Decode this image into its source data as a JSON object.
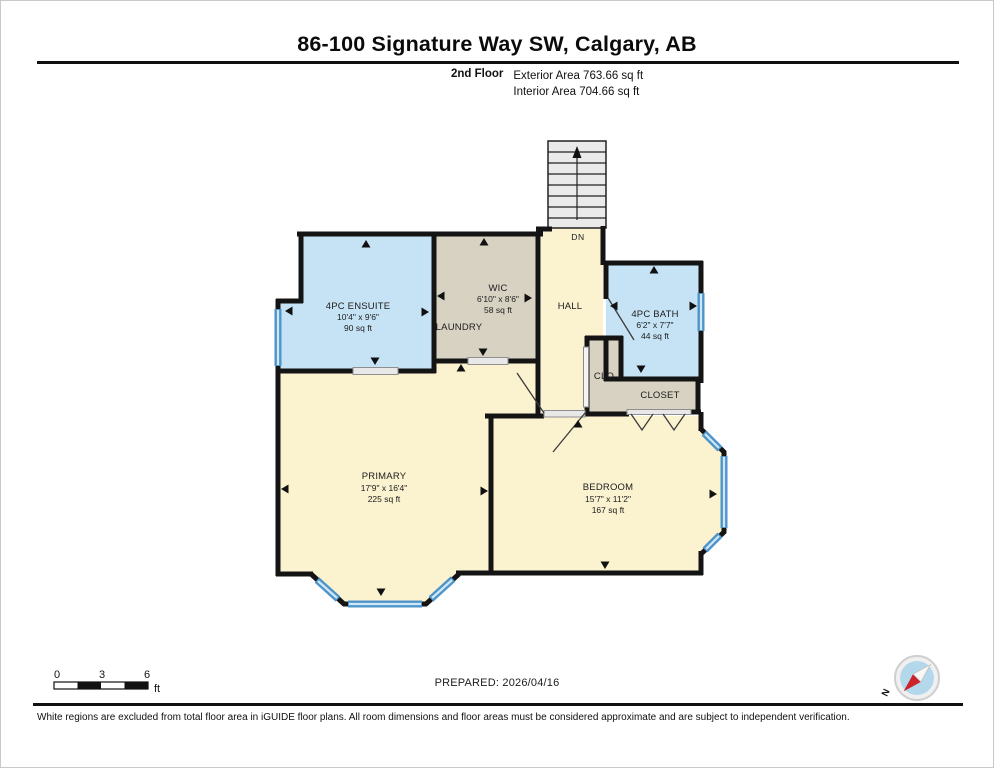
{
  "header": {
    "title": "86-100 Signature Way SW, Calgary, AB",
    "floor_label": "2nd Floor",
    "exterior_area": "Exterior Area 763.66 sq ft",
    "interior_area": "Interior Area 704.66 sq ft"
  },
  "plan": {
    "stairs_label": "DN",
    "rooms": {
      "ensuite": {
        "name": "4PC ENSUITE",
        "dims": "10'4\" x 9'6\"",
        "area": "90 sq ft"
      },
      "wic": {
        "name": "WIC",
        "dims": "6'10\" x 8'6\"",
        "area": "58 sq ft"
      },
      "laundry": {
        "name": "LAUNDRY"
      },
      "hall": {
        "name": "HALL"
      },
      "bath": {
        "name": "4PC BATH",
        "dims": "6'2\" x 7'7\"",
        "area": "44 sq ft"
      },
      "clo": {
        "name": "CLO"
      },
      "closet": {
        "name": "CLOSET"
      },
      "primary": {
        "name": "PRIMARY",
        "dims": "17'9\" x 16'4\"",
        "area": "225 sq ft"
      },
      "bedroom": {
        "name": "BEDROOM",
        "dims": "15'7\" x 11'2\"",
        "area": "167 sq ft"
      }
    },
    "colors": {
      "bathroom_fill": "#c6e3f5",
      "closet_fill": "#d8d2c2",
      "room_fill": "#fbf2d0",
      "stairs_fill": "#eaeaea",
      "wall": "#141414",
      "window": "#4f94c9",
      "compass_needle": "#cc2229"
    }
  },
  "scale_bar": {
    "t0": "0",
    "t1": "3",
    "t2": "6",
    "unit": "ft"
  },
  "footer": {
    "prepared": "PREPARED: 2026/04/16",
    "compass_label": "N",
    "disclaimer": "White regions are excluded from total floor area in iGUIDE floor plans. All room dimensions and floor areas must be considered approximate and are subject to independent verification."
  }
}
